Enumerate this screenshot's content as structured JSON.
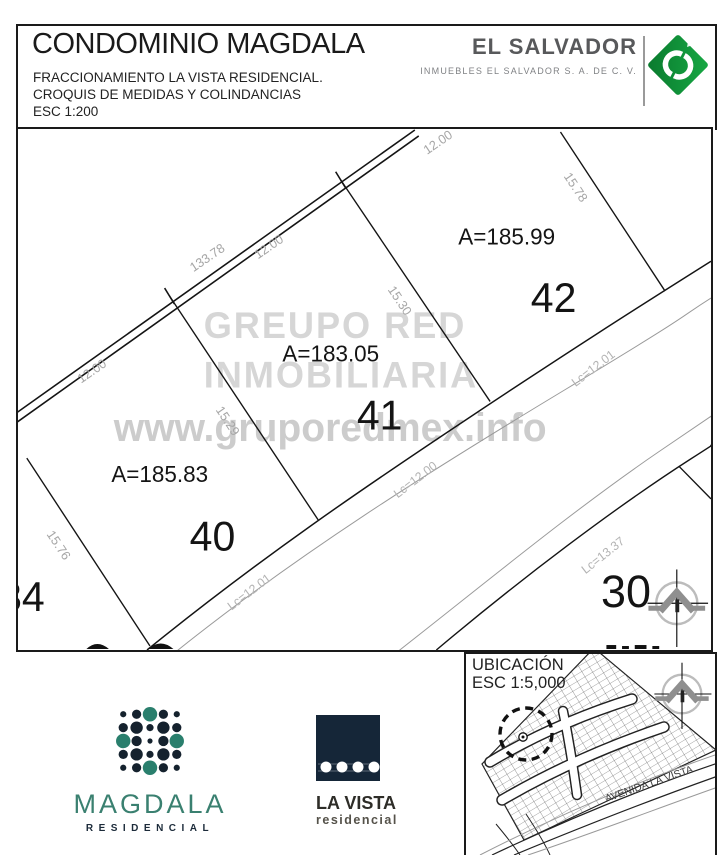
{
  "header": {
    "title": "CONDOMINIO MAGDALA",
    "subtitle1": "FRACCIONAMIENTO LA VISTA RESIDENCIAL.",
    "subtitle2": "CROQUIS DE MEDIDAS Y COLINDANCIAS",
    "scale": "ESC 1:200"
  },
  "brand": {
    "name": "EL SALVADOR",
    "subtitle": "INMUEBLES EL SALVADOR S. A. DE C. V.",
    "logo_green": "#129a3f"
  },
  "watermark": {
    "line1": "GREUPO RED",
    "line2": "INMOBILIARIA",
    "line3": "www.gruporedmex.info"
  },
  "map": {
    "lot40": {
      "number": "40",
      "area": "A=185.83"
    },
    "lot41": {
      "number": "41",
      "area": "A=183.05"
    },
    "lot42": {
      "number": "42",
      "area": "A=185.99"
    },
    "lot30": {
      "number": "30"
    },
    "lot34": {
      "number": "34"
    },
    "dims": {
      "frontage40": "12.00",
      "street_total": "133.78",
      "frontage41": "12.00",
      "frontage42": "12.00",
      "depth_40_left": "15.76",
      "depth_40_41": "15.29",
      "depth_41_42": "15.30",
      "depth_42_right": "15.78"
    },
    "curves": {
      "c40": "Lc=12.01",
      "c41": "Lc=12.00",
      "c42": "Lc=12.01",
      "c30": "Lc=13.37"
    }
  },
  "footer": {
    "magdala_name": "MAGDALA",
    "magdala_sub": "RESIDENCIAL",
    "lavista_name": "LA VISTA",
    "lavista_sub": "residencial",
    "ubicacion_title": "UBICACIÓN",
    "ubicacion_scale": "ESC 1:5,000",
    "avenue": "AVENIDA LA VISTA"
  },
  "colors": {
    "magdala_teal": "#2a7f6d",
    "magdala_navy": "#15222e",
    "watermark_gray": "#d6d6d6",
    "dim_gray": "#a6a6a6"
  }
}
